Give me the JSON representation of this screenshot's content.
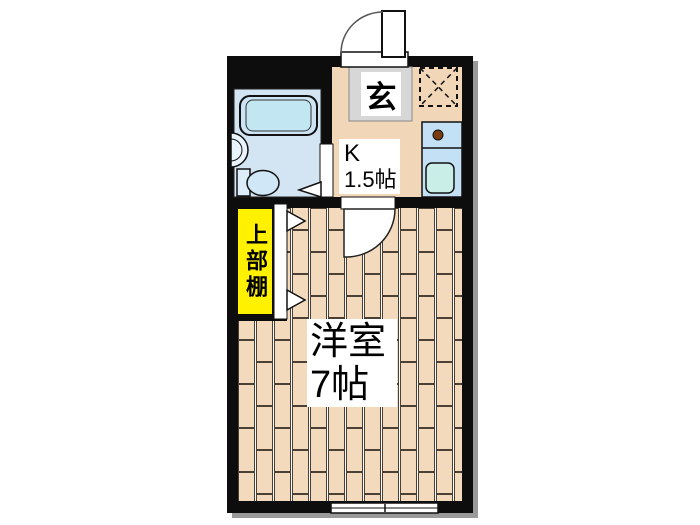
{
  "plan": {
    "title": "studio-apartment-floorplan",
    "rooms": {
      "entrance": {
        "label": "玄"
      },
      "kitchen": {
        "label_line1": "K",
        "label_line2": "1.5帖"
      },
      "closet": {
        "label": "上部棚"
      },
      "western_room": {
        "label_line1": "洋室",
        "label_line2": "7帖"
      }
    },
    "colors": {
      "wall": "#0d0d0d",
      "shadow": "#9a9a9a",
      "kitchen_floor": "#f2d6b8",
      "plank": "#f3dabd",
      "plank_gap": "#ffffff",
      "plank_line": "#4a4036",
      "bathroom_floor": "#d3e4f3",
      "bathtub_outer": "#cde4f5",
      "bathtub_inner": "#c2e7f3",
      "basin": "#e9f3fb",
      "toilet_tank": "#dcedf8",
      "toilet_bowl": "#cfe7f6",
      "counter": "#c3e0f4",
      "sink": "#c9eee7",
      "burner": "#7b3c10",
      "genkan_tile": "#d7d7d7",
      "shelf_yellow": "#fff100",
      "door_white": "#ffffff"
    }
  }
}
